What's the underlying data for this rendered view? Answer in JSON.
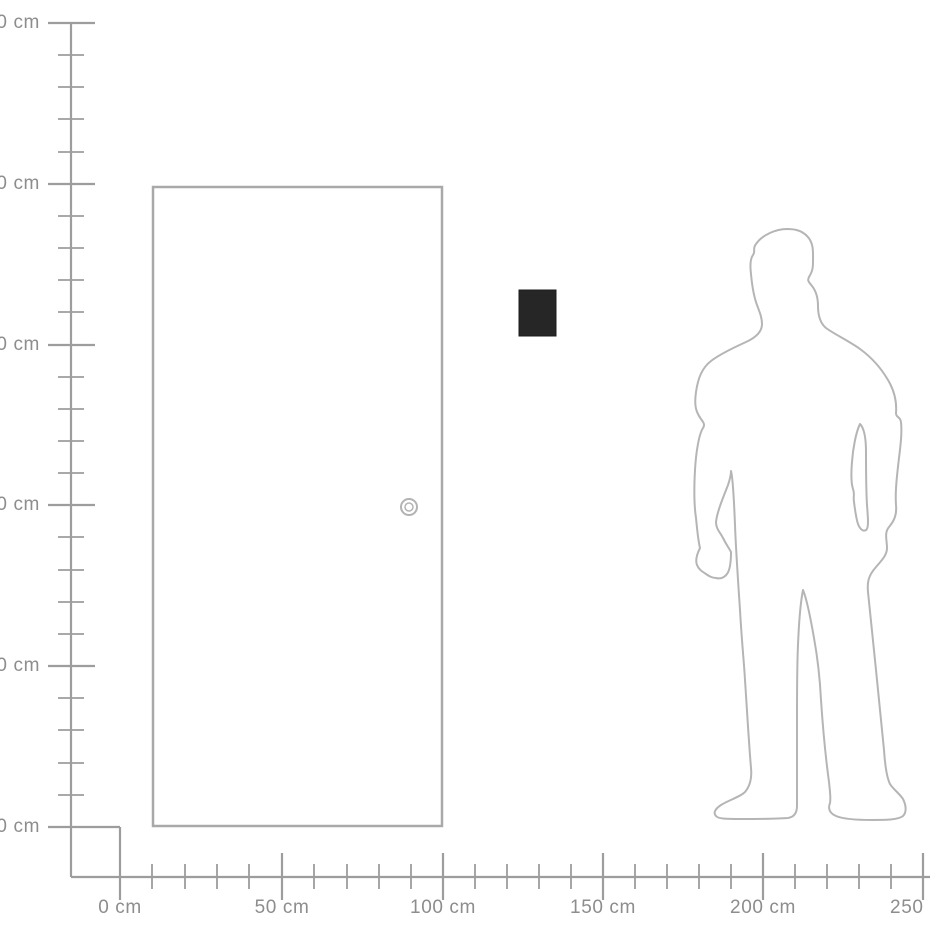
{
  "diagram": {
    "kind": "product-size-scale-diagram",
    "unit": "cm",
    "background_color": "#ffffff"
  },
  "rulers": {
    "vertical": {
      "orientation": "vertical",
      "range_cm": [
        0,
        250
      ],
      "step_major_cm": 50,
      "step_minor_cm": 10,
      "labels": [
        "250 cm",
        "200 cm",
        "150 cm",
        "100 cm",
        "50 cm",
        "0 cm"
      ],
      "line_color": "#9d9d9d",
      "label_color": "#8d8d8d"
    },
    "horizontal": {
      "orientation": "horizontal",
      "range_cm": [
        0,
        250
      ],
      "step_major_cm": 50,
      "step_minor_cm": 10,
      "labels": [
        "0 cm",
        "50 cm",
        "100 cm",
        "150 cm",
        "200 cm",
        "250 cm"
      ],
      "line_color": "#9d9d9d",
      "label_color": "#8d8d8d"
    }
  },
  "scene": {
    "door": {
      "label": "door outline with round handle",
      "width_cm": 90,
      "height_cm": 200,
      "left_at_cm": 10,
      "outline_color": "#a9a9a9",
      "fill": "#ffffff"
    },
    "product": {
      "label": "dark rectangular product shown at wall height",
      "width_cm": 12,
      "height_cm": 14,
      "center_at_cm_x": 130,
      "top_at_cm_y": 167,
      "color": "#262626"
    },
    "person": {
      "label": "standing man silhouette for scale",
      "height_cm": 186,
      "outline_color": "#b5b5b5"
    }
  }
}
